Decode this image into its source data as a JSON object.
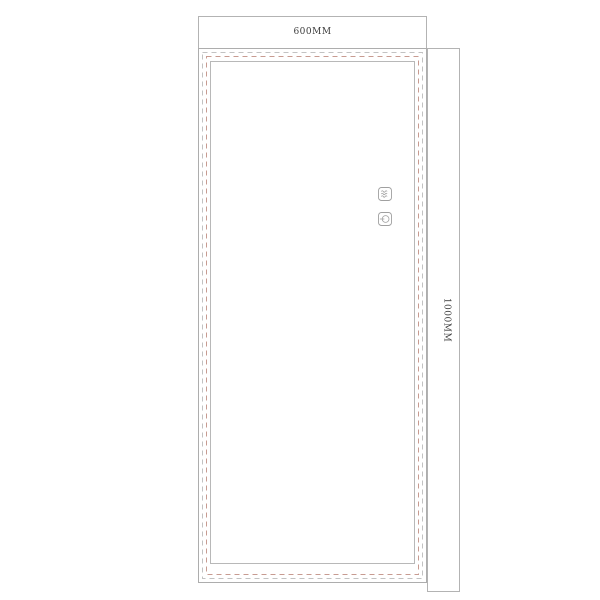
{
  "drawing": {
    "type": "led-mirror-technical-drawing",
    "dimensions": {
      "width_label": "600MM",
      "height_label": "1000MM"
    },
    "icons": [
      {
        "name": "defogger-icon",
        "glyph": "three horizontal wavy lines in rounded square"
      },
      {
        "name": "power-touch-icon",
        "glyph": "circle with horizontal line at left in rounded square"
      }
    ],
    "colors": {
      "background": "#ffffff",
      "outline": "#adadad",
      "dimension_border": "#b3b3b3",
      "dash_gray": "#c2c2c2",
      "dash_red": "#c79b91",
      "inner_border": "#b8b8b8",
      "icon_stroke": "#a0a0a0",
      "text": "#3c3c3c"
    }
  }
}
